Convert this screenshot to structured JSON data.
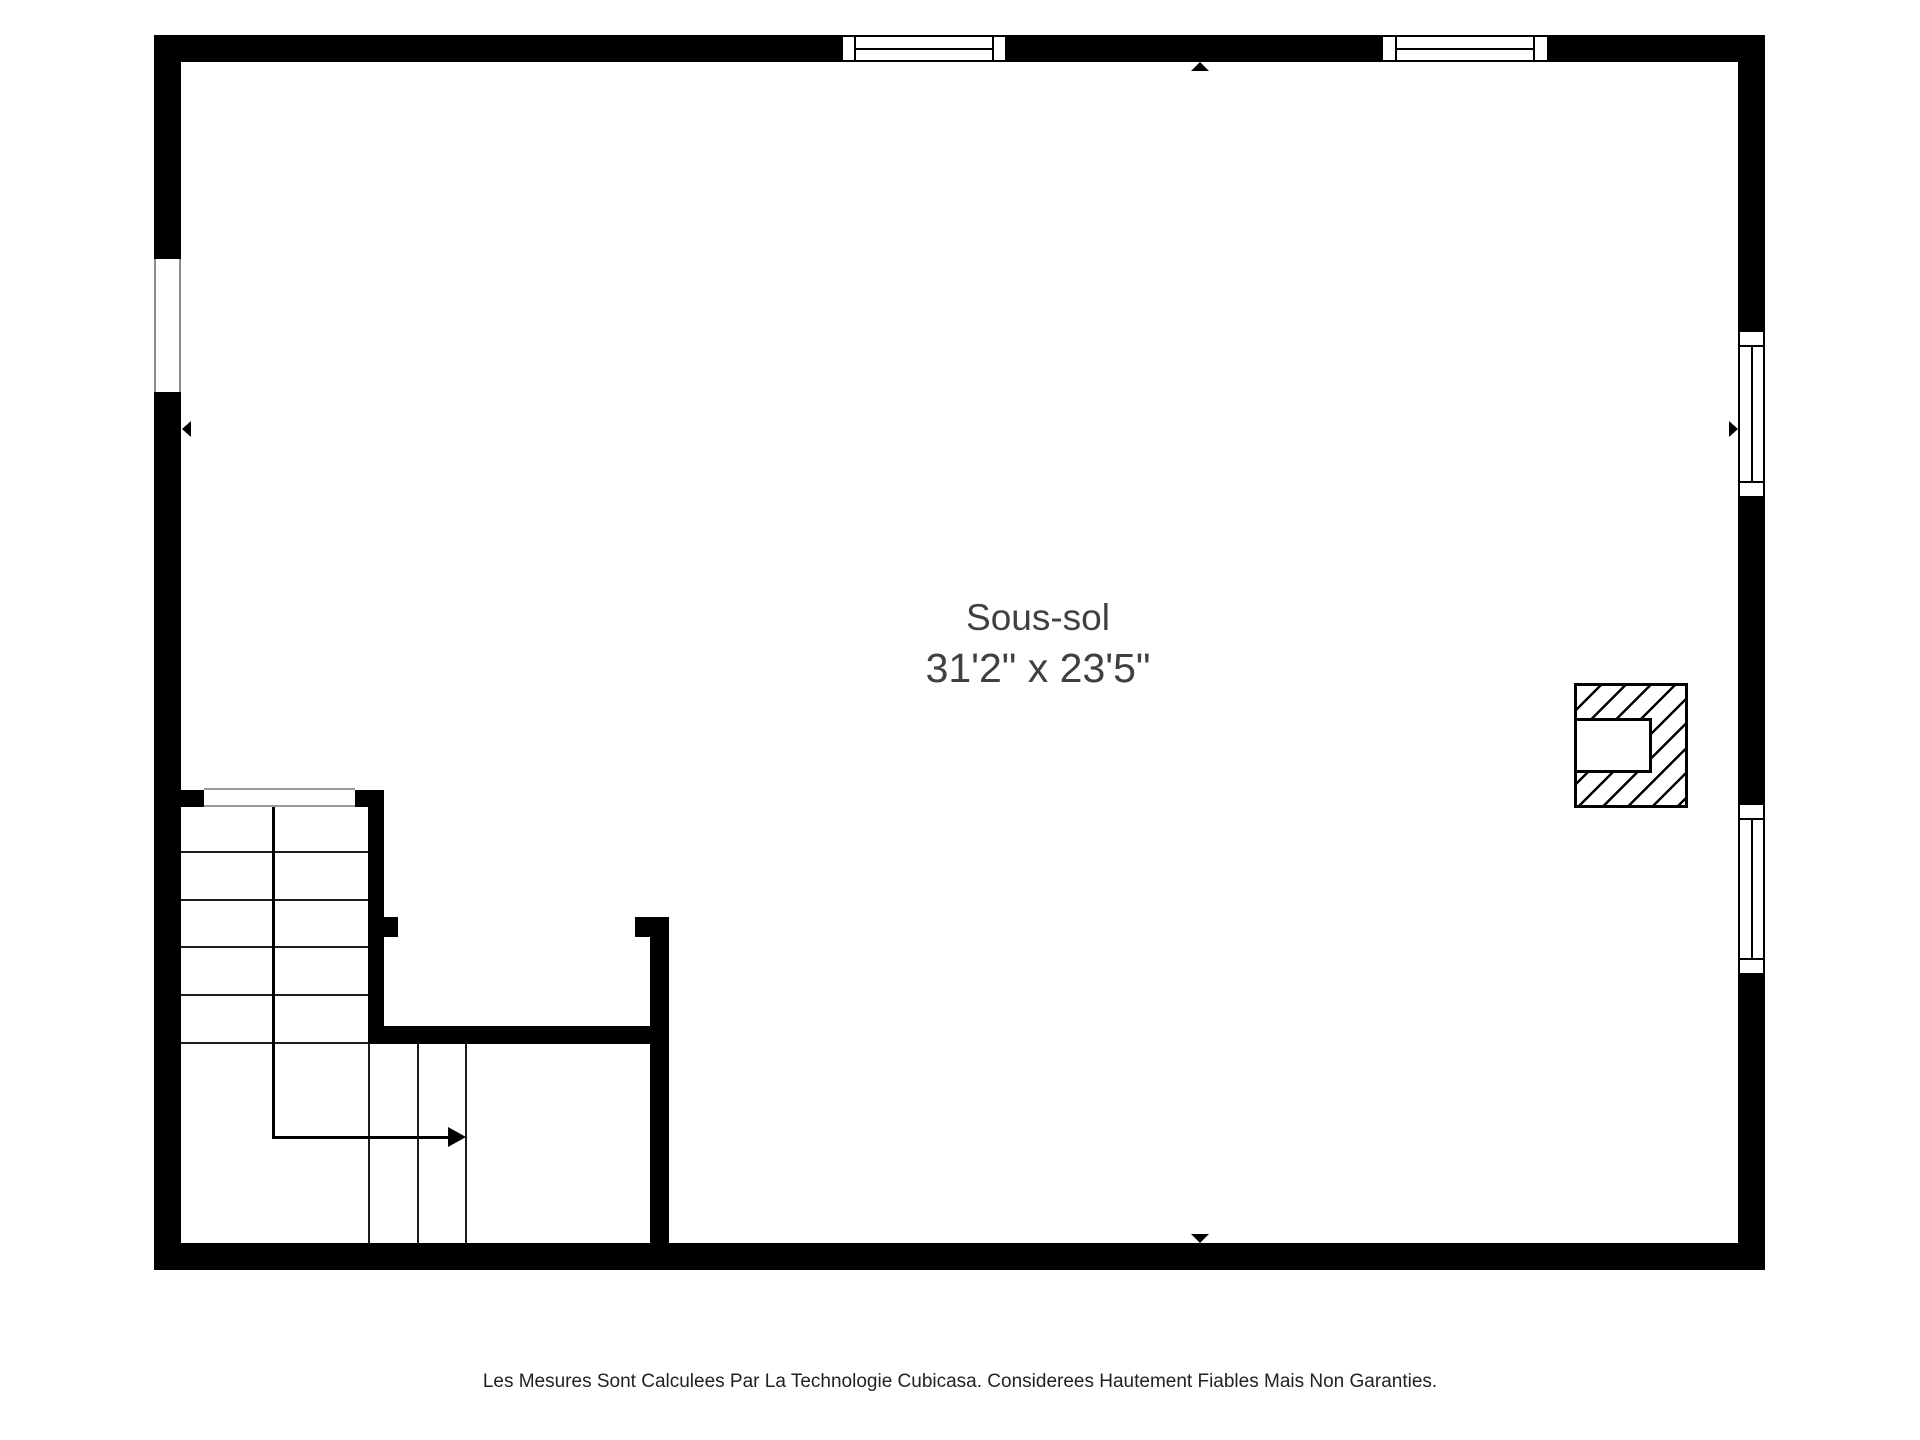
{
  "floor_plan": {
    "room_label": {
      "name": "Sous-sol",
      "dimensions": "31'2\" x 23'5\""
    },
    "disclaimer": "Les Mesures Sont Calculees Par La Technologie Cubicasa. Considerees Hautement Fiables Mais Non Garanties.",
    "colors": {
      "wall": "#000000",
      "background": "#ffffff",
      "room_label_text": "#3d4045",
      "disclaimer_text": "#222222",
      "opening_outline": "#8a8a8a",
      "stair_tread": "#1c1c1c"
    },
    "elements": {
      "windows": [
        "top-wall-window-left",
        "top-wall-window-right",
        "right-wall-window-upper",
        "right-wall-window-lower"
      ],
      "openings": [
        "left-wall-opening",
        "stair-door-opening",
        "stair-entry-opening"
      ],
      "markers": [
        "entry-triangle-top",
        "entry-triangle-bottom",
        "entry-triangle-left",
        "entry-triangle-right"
      ],
      "features": [
        "l-shaped-staircase-with-direction-arrow",
        "hatched-chimney"
      ]
    }
  }
}
